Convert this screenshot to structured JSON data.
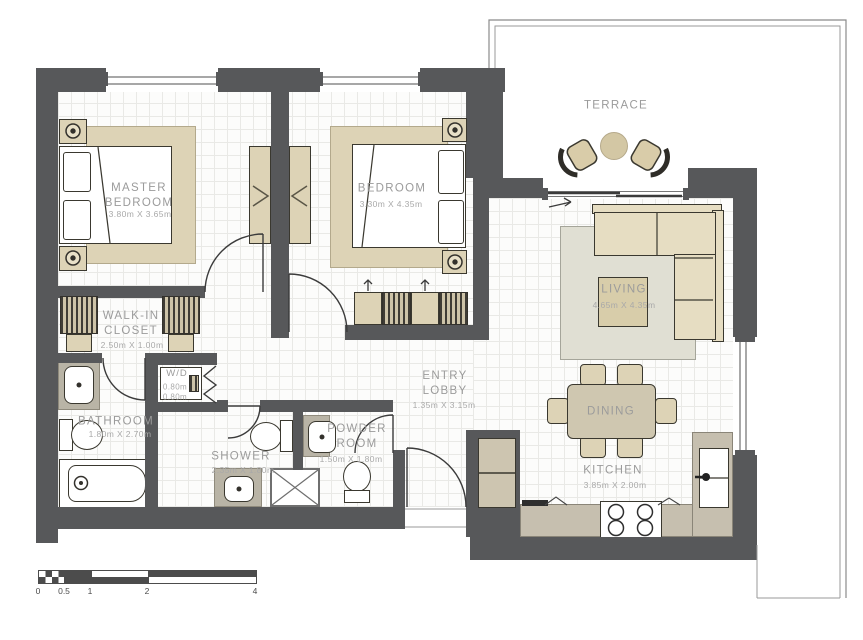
{
  "rooms": {
    "master_bedroom": {
      "name": "MASTER BEDROOM",
      "dims": "3.80m X 3.65m"
    },
    "bedroom": {
      "name": "BEDROOM",
      "dims": "3.30m X 4.35m"
    },
    "terrace": {
      "name": "TERRACE"
    },
    "living": {
      "name": "LIVING",
      "dims": "4.65m X 4.35m"
    },
    "dining": {
      "name": "DINING"
    },
    "kitchen": {
      "name": "KITCHEN",
      "dims": "3.85m X 2.00m"
    },
    "entry_lobby": {
      "name": "ENTRY LOBBY",
      "dims": "1.35m X 3.15m"
    },
    "walk_in_closet": {
      "name": "WALK-IN CLOSET",
      "dims": "2.50m X 1.00m"
    },
    "washer_dryer": {
      "name": "W/D",
      "width": "0.80m",
      "depth": "0.80m"
    },
    "bathroom": {
      "name": "BATHROOM",
      "dims": "1.80m X 2.70m"
    },
    "shower": {
      "name": "SHOWER",
      "dims": "2.35m X 1.80m"
    },
    "powder_room": {
      "name": "POWDER ROOM",
      "dims": "1.50m X 1.80m"
    }
  },
  "scale_bar": {
    "labels": [
      "0",
      "0.5",
      "1",
      "2",
      "4"
    ]
  },
  "colors": {
    "wall": "#57585a",
    "furniture_tan": "#ddd3b6",
    "counter": "#c6bfaf",
    "rug": "#e0dfd3",
    "label_text": "#9b9b9b"
  }
}
